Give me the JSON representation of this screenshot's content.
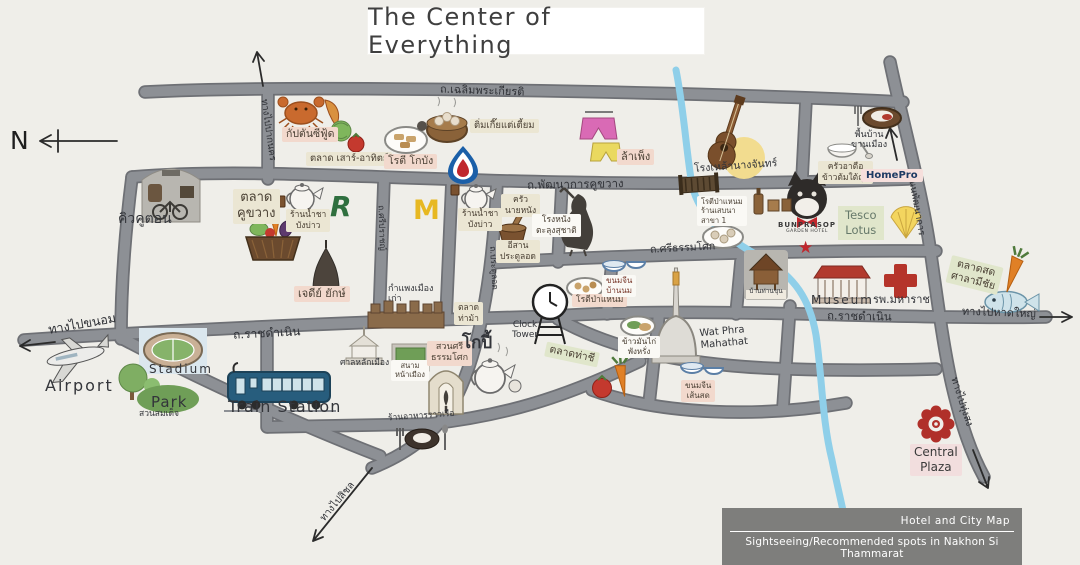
{
  "title": "The Center of Everything",
  "compass": {
    "label": "N"
  },
  "legend": {
    "line1": "Hotel and City Map",
    "line2": "Sightseeing/Recommended spots in Nakhon Si Thammarat"
  },
  "colors": {
    "background": "#efeee9",
    "road_fill": "#8d9095",
    "road_outline": "#6e7075",
    "river": "#8fcfe9",
    "accent_red": "#b5342a",
    "tag_beige": "#ebe6d3",
    "tag_pink": "#f2d9cd",
    "tag_green": "#e0e6cb",
    "legend_gray": "#7e7e7c"
  },
  "roads": {
    "chaloem_phrakiat": "ถ.เฉลิมพระเกียรติ",
    "phatthanakan_khukhwang": "ถ.พัฒนาการคูขวาง",
    "si_thammasok": "ถ.ศรีธรรมโศก",
    "ratchadamnoen_west": "ถ.ราชดำเนิน",
    "ratchadamnoen_east": "ถ.ราชดำเนิน",
    "to_khanom": "ทางไปขนอม",
    "to_hatyai": "ทางไปหาดใหญ่",
    "to_paknakhon": "ทางไปปากนคร",
    "to_thungsong": "ทางไปทุ่งสง",
    "to_sichon": "ทางไปสิชล",
    "pratu_lot": "ถ.ประตูลอด",
    "si_prat": "ถ.ศรีปราชญ์",
    "phatthanakan": "ถนนพัฒนาการ"
  },
  "logos": {
    "mcdonalds": "M",
    "r_mark": "R"
  },
  "icons": {
    "star": "★"
  },
  "pois": {
    "kiw_khu_ton": "คิวคูตอน",
    "talat_khukhwang": "ตลาด\nคูขวาง",
    "tea_bangbao_1": "ร้านน้ำชา\nบังบ่าว",
    "tea_bangbao_2": "ร้านน้ำชา\nบังบ่าว",
    "captain_seafood": "กัปตันซีฟู้ด",
    "weekend_market": "ตลาด เสาร์-อาทิตย์",
    "roti_kobang": "โรตี โกบัง",
    "dimsum": "ติ่มเกี๊ยแต่เตี้ยม",
    "lampheng": "ล้าเพ็ง",
    "rong_lao_nang_chan": "โรงเหล้านางจันทร์",
    "local_food": "พื้นบ้าน\nขานเมือง",
    "krua_atue": "ครัวอาตือ\nข้าวต้มใต้ถุน",
    "homepro": "HomePro",
    "krua_nai_nang": "ครัว\nนายหนัง",
    "isan_pratulot": "อีสาน\nประตูลอด",
    "nang_talung": "โรงหนัง\nตะลุงสุชาติ",
    "roti_panaem_branch": "โรตีป่าแหนม\nร้านเสบนา\nสาขา 1",
    "bunprasop": {
      "name": "BUNPRASOP",
      "sub": "GARDEN HOTEL"
    },
    "tesco_lotus": "Tesco\nLotus",
    "chedi_yak": "เจดีย์ ยักษ์",
    "city_wall": "กำแพงเมือง\nเก่า",
    "talat_thama": "ตลาด\nท่าม้า",
    "clock_tower": "Clock\nTower",
    "roti_panaem": "โรตีป่าแหนม",
    "khanom_jeen_bannom": "ขนมจีน\nบ้านนม",
    "baan_than_khun": "บ้านท่านขุน",
    "wat_phra_mahathat": "Wat Phra\nMahathat",
    "khao_man_kai": "ข้าวมันไก่\nพังหรั่ง",
    "talat_thachi": "ตลาดท่าชี",
    "khanom_jeen_sensot": "ขนมจีน\nเส้นสด",
    "museum": "Museum",
    "maharat_hospital": "รพ.มหาราช",
    "talat_salamichai": "ตลาดสด\nศาลามีชัย",
    "central_plaza": "Central\nPlaza",
    "san_lak_mueang": "ศาลหลักเมือง",
    "sanam_na_mueang": "สนาม\nหน้าเมือง",
    "suan_si_thammasok": "สวนศรี\nธรรมโศก",
    "kopi": "โกปี้",
    "raan_ahan_rao_ruea": "ร้านอาหารราวเรือ",
    "train_station": "Train Station",
    "stadium": "Stadium",
    "park": {
      "en": "Park",
      "th": "สวนสมเด็จ"
    },
    "airport": "Airport"
  }
}
